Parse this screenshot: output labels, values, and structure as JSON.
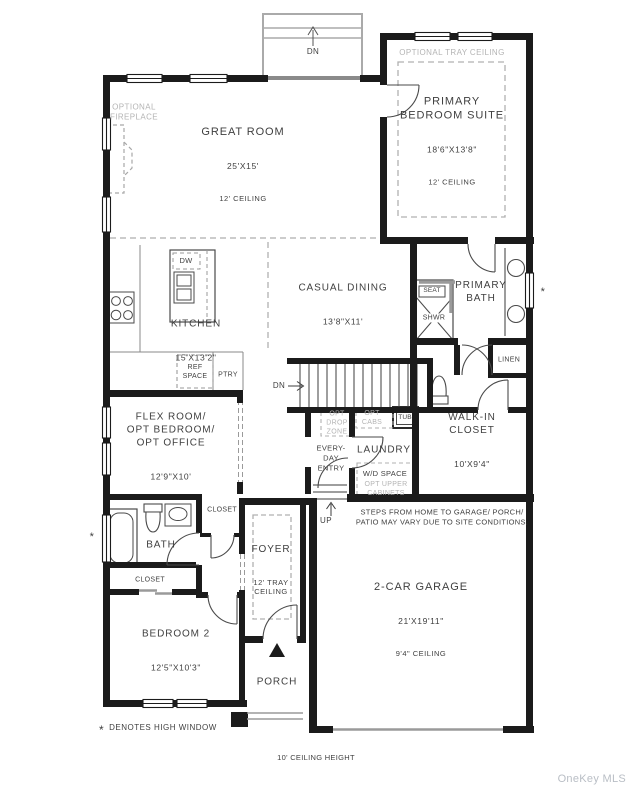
{
  "plan": {
    "rooms": {
      "great_room": {
        "name": "GREAT ROOM",
        "dims": "25'X15'",
        "ceiling": "12' CEILING"
      },
      "primary_bedroom": {
        "name": "PRIMARY\nBEDROOM SUITE",
        "dims": "18'6\"X13'8\"",
        "ceiling": "12' CEILING",
        "option": "OPTIONAL TRAY CEILING"
      },
      "kitchen": {
        "name": "KITCHEN",
        "dims": "15'X13'2\""
      },
      "casual_dining": {
        "name": "CASUAL DINING",
        "dims": "13'8\"X11'"
      },
      "primary_bath": {
        "name": "PRIMARY\nBATH"
      },
      "walk_in_closet": {
        "name": "WALK-IN\nCLOSET",
        "dims": "10'X9'4\""
      },
      "flex_room": {
        "name": "FLEX ROOM/\nOPT BEDROOM/\nOPT OFFICE",
        "dims": "12'9\"X10'"
      },
      "laundry": {
        "name": "LAUNDRY"
      },
      "everyday_entry": {
        "name": "EVERY-\nDAY\nENTRY"
      },
      "bath2": {
        "name": "BATH"
      },
      "closet_hall": {
        "name": "CLOSET"
      },
      "closet_bedroom2": {
        "name": "CLOSET"
      },
      "linen": {
        "name": "LINEN"
      },
      "foyer": {
        "name": "FOYER",
        "ceiling": "12' TRAY\nCEILING"
      },
      "bedroom2": {
        "name": "BEDROOM 2",
        "dims": "12'5\"X10'3\""
      },
      "garage": {
        "name": "2-CAR GARAGE",
        "dims": "21'X19'11\"",
        "ceiling": "9'4\" CEILING"
      },
      "porch": {
        "name": "PORCH"
      }
    },
    "features": {
      "optional_fireplace": "OPTIONAL\nFIREPLACE",
      "dw": "DW",
      "ref_space": "REF\nSPACE",
      "pantry": "PTRY",
      "seat": "SEAT",
      "shower": "SHWR",
      "opt_drop_zone": "OPT\nDROP\nZONE",
      "opt_cabs": "OPT\nCABS",
      "tub": "TUB",
      "wd_space": "W/D SPACE",
      "opt_upper_cabinets": "OPT UPPER\nCABINETS",
      "dn_stoop": "DN",
      "dn_stairs": "DN",
      "up": "UP",
      "high_window_mark": "*"
    },
    "notes": {
      "steps": "STEPS FROM HOME TO GARAGE/ PORCH/\nPATIO MAY VARY DUE TO SITE CONDITIONS.",
      "legend_symbol": "*",
      "legend_text": "DENOTES HIGH WINDOW",
      "ceiling_height": "10' CEILING HEIGHT"
    },
    "watermark": "OneKey MLS",
    "colors": {
      "wall": "#1b1b1b",
      "text": "#3f3f3f",
      "optional_gray": "#b4b4b4",
      "line_gray": "#999999",
      "watermark_gray": "#b9bec5"
    }
  }
}
